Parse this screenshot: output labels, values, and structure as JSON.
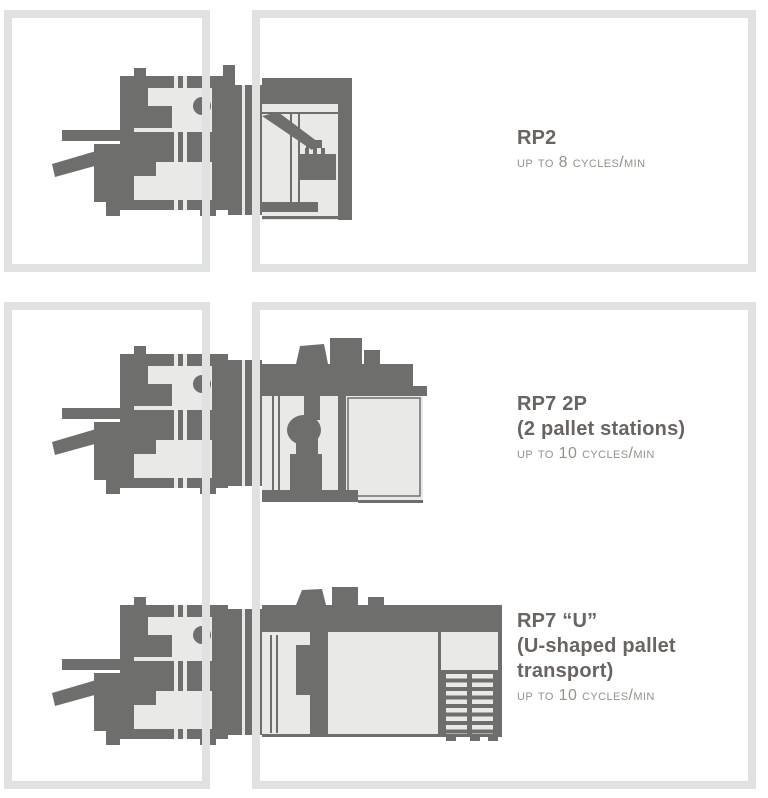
{
  "colors": {
    "background": "#ffffff",
    "frame_border": "#e0e2e1",
    "machine_dark": "#6e6e6c",
    "machine_light": "#e9e9e7",
    "title_text": "#6a6461",
    "throughput_text": "#97918a"
  },
  "sections": [
    {
      "title": "RP2",
      "subtitle": "",
      "throughput": "UP TO 8 CYCLES/MIN",
      "illustration": "press-line-with-robot-unload-cell"
    },
    {
      "title": "RP7 2P",
      "subtitle": "(2 pallet stations)",
      "throughput": "UP TO 10 CYCLES/MIN",
      "illustration": "press-line-with-robot-and-two-pallet-stations"
    },
    {
      "title": "RP7 “U”",
      "subtitle": "(U-shaped pallet transport)",
      "throughput": "UP TO 10 CYCLES/MIN",
      "illustration": "press-line-with-robot-and-u-shaped-pallet-transport"
    }
  ]
}
